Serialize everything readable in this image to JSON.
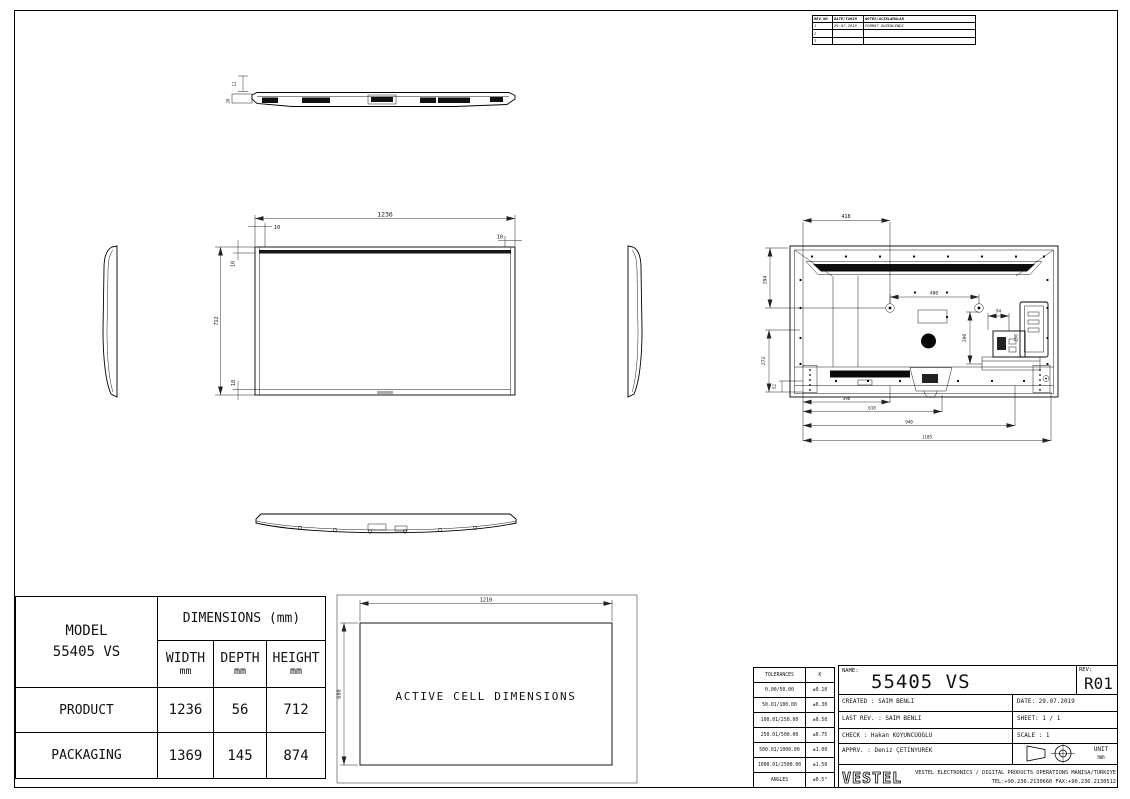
{
  "revision_table": {
    "headers": {
      "no": "REV.NO",
      "date": "DATE/TARIH",
      "notes": "NOTES/ACIKLAMALAR"
    },
    "rows": [
      {
        "no": "1",
        "date": "29.07.2019",
        "notes": "FORMAT DUZENLENDI"
      },
      {
        "no": "2",
        "date": "",
        "notes": ""
      },
      {
        "no": "3",
        "date": "",
        "notes": ""
      }
    ]
  },
  "drawing": {
    "front_view": {
      "width": "1236",
      "height": "712",
      "bezel_top": "10",
      "bezel_left": "10",
      "bezel_right": "10",
      "bezel_bottom": "18"
    },
    "top_view": {
      "edge_thickness": "11",
      "depth": "26"
    },
    "rear_view": {
      "vesa_offset_left": "418",
      "top_to_vesa": "294",
      "vesa_horizontal": "400",
      "vesa_to_bottom": "200",
      "io_width": "94",
      "io_panel": "150",
      "left_vertical": "273",
      "corner_offset": "52",
      "bottom_1": "396",
      "bottom_2": "618",
      "bottom_3": "940",
      "bottom_4": "1105"
    },
    "active_cell": {
      "label": "ACTIVE CELL DIMENSIONS",
      "width": "1210",
      "height": "680"
    }
  },
  "dimensions_table": {
    "model_label": "MODEL",
    "model_value": "55405 VS",
    "header": "DIMENSIONS (mm)",
    "columns": [
      {
        "label": "WIDTH",
        "unit": "mm"
      },
      {
        "label": "DEPTH",
        "unit": "mm"
      },
      {
        "label": "HEIGHT",
        "unit": "mm"
      }
    ],
    "rows": [
      {
        "label": "PRODUCT",
        "width": "1236",
        "depth": "56",
        "height": "712"
      },
      {
        "label": "PACKAGING",
        "width": "1369",
        "depth": "145",
        "height": "874"
      }
    ]
  },
  "title_block": {
    "tolerances": {
      "rows": [
        [
          "TOLERANCES",
          "K"
        ],
        [
          "0.00/50.00",
          "±0.10"
        ],
        [
          "50.01/100.00",
          "±0.30"
        ],
        [
          "100.01/250.00",
          "±0.50"
        ],
        [
          "250.01/500.00",
          "±0.75"
        ],
        [
          "500.01/1000.00",
          "±1.00"
        ],
        [
          "1000.01/2500.00",
          "±1.50"
        ],
        [
          "ANGLES",
          "±0.5°"
        ]
      ]
    },
    "name_label": "NAME:",
    "name_value": "55405 VS",
    "rev_label": "REV:",
    "rev_value": "R01",
    "created": "CREATED : SAIM BENLI",
    "date": "DATE: 29.07.2019",
    "last_rev": "LAST REV. : SAIM BENLI",
    "sheet": "SHEET: 1 / 1",
    "check": "CHECK : Hakan KOYUNCUOGLU",
    "scale": "SCALE : 1",
    "apprv": "APPRV. : Deniz ÇETINYUREK",
    "unit_label": "UNIT",
    "unit_value": "mm",
    "logo": "VESTEL",
    "company_line": "VESTEL ELECTRONICS / DIGITAL PRODUCTS OPERATIONS MANISA/TURKIYE",
    "contact_line": "TEL:+90.236.2130660 FAX:+90.236.2130512"
  }
}
